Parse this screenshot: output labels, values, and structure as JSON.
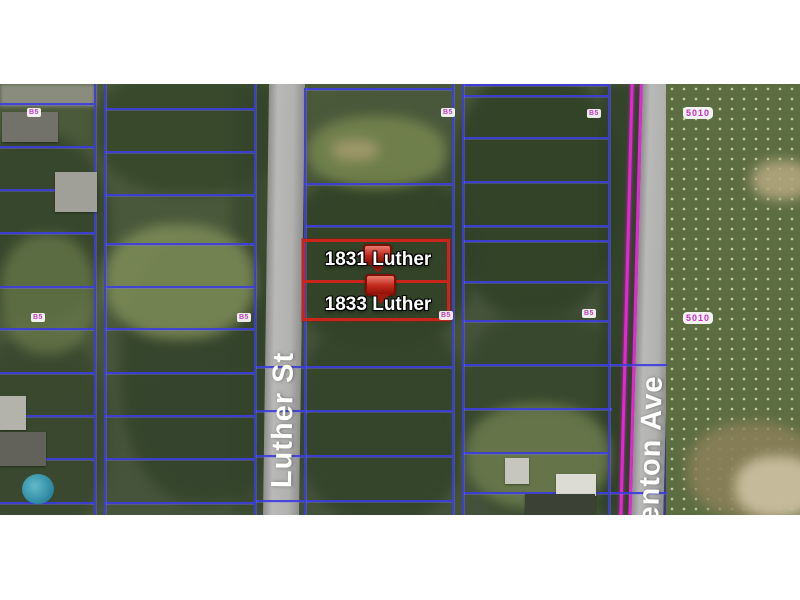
{
  "map": {
    "title": "Aerial parcel map",
    "streets": {
      "luther": "Luther St",
      "kenton": "enton Ave"
    },
    "parcels": {
      "p1831": "1831 Luther",
      "p1833": "1833 Luther"
    },
    "badges": {
      "lot_id": "B5",
      "route_id": "5010"
    },
    "colors": {
      "parcel_line": "#3e3edc",
      "highlight": "#c9251b",
      "route_line": "#e626d6",
      "road": "#a6a6a6"
    }
  }
}
